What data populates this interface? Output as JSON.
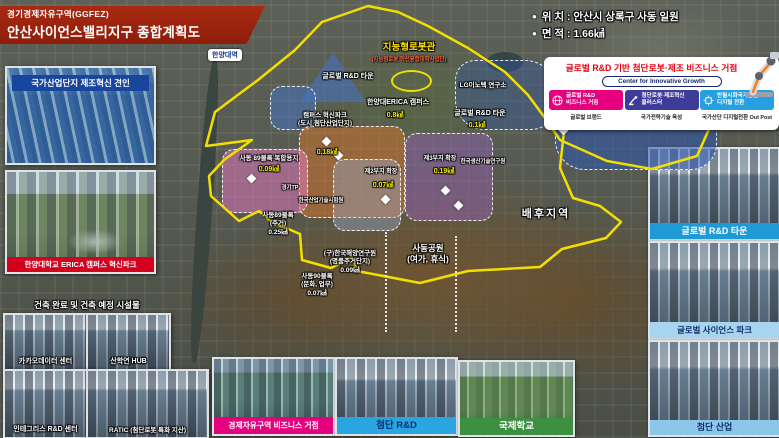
{
  "header": {
    "agency": "경기경제자유구역(GGFEZ)",
    "title": "안산사이언스밸리지구 종합계획도",
    "banner_color": "#8f1d0a"
  },
  "info": {
    "bullet": "●",
    "lines": [
      "위 치 : 안산시 상록구 사동 일원",
      "면 적 : 1.66㎢"
    ]
  },
  "left_column": {
    "industrial_panel": {
      "caption": "국가산업단지 제조혁신 견인",
      "caption_bg": "#18469e"
    },
    "erica_panel": {
      "caption": "한양대학교 ERICA 캠퍼스 혁신파크",
      "caption_bg": "#d3001e"
    },
    "facilities": {
      "heading": "건축 완료 및 건축 예정 시설물",
      "items": [
        {
          "label": "카카오데이터 센터"
        },
        {
          "label": "산학연 HUB"
        },
        {
          "label": "인테그리스 R&D 센터"
        },
        {
          "label": "RATIC (첨단로봇 특화 지산)"
        }
      ]
    }
  },
  "growth_card": {
    "title": "글로벌 R&D 기반 첨단로봇·제조 비즈니스 거점",
    "subtitle": "Center for Innovative Growth",
    "pillars": [
      {
        "line1": "글로벌 R&D",
        "line2": "비즈니스 거점",
        "footer": "글로벌 브랜드",
        "color": "#e6007d",
        "icon": "globe-icon"
      },
      {
        "line1": "첨단로봇·제조혁신",
        "line2": "클러스터",
        "footer": "국가전략기술 육성",
        "color": "#3d3d99",
        "icon": "robot-arm-icon"
      },
      {
        "line1": "반월시화국가산단",
        "line2": "디지털 전환",
        "footer": "국가산단 디지털전환 Out Post",
        "color": "#28a0e0",
        "icon": "digital-icon"
      }
    ]
  },
  "right_column": {
    "panels": [
      {
        "caption": "글로벌 R&D 타운",
        "bg": "#1e9ad6",
        "text": "#ffffff"
      },
      {
        "caption": "글로벌 사이언스 파크",
        "bg": "#a8d4ee",
        "text": "#0c2f6e"
      },
      {
        "caption": "첨단 산업",
        "bg": "#8cc6e8",
        "text": "#0c2f6e"
      }
    ]
  },
  "bottom_row": {
    "panels": [
      {
        "caption": "경제자유구역 비즈니스 거점",
        "bg": "#e6007d",
        "text": "#ffffff"
      },
      {
        "caption": "첨단 R&D",
        "bg": "#29a5e2",
        "text": "#0c2f6e"
      },
      {
        "caption": "국제학교",
        "bg": "#3d8f42",
        "text": "#ffffff"
      }
    ]
  },
  "map": {
    "station": "한양대역",
    "boundary_color": "#f2df00",
    "labels": [
      {
        "name": "label-robot-hall",
        "x": 409,
        "y": 42,
        "cls": "map-title-yellow",
        "lines": [
          "지능형로봇관"
        ]
      },
      {
        "name": "label-robot-hall-sub",
        "x": 409,
        "y": 57,
        "cls": "map-sub-red",
        "lines": [
          "(지능형로봇 혁신융합대학사업단)"
        ]
      },
      {
        "name": "label-global-rnd-west",
        "x": 348,
        "y": 72,
        "cls": "zn",
        "lines": [
          "글로벌 R&D 타운"
        ]
      },
      {
        "name": "label-erica-campus",
        "x": 398,
        "y": 98,
        "cls": "zn",
        "lines": [
          "한양대ERICA 캠퍼스"
        ]
      },
      {
        "name": "label-erica-area",
        "x": 395,
        "y": 111,
        "cls": "av",
        "lines": [
          "0.8㎢"
        ]
      },
      {
        "name": "label-lg-innotek",
        "x": 483,
        "y": 82,
        "cls": "zn sm",
        "lines": [
          "LG이노텍 연구소"
        ]
      },
      {
        "name": "label-global-rnd-east",
        "x": 480,
        "y": 109,
        "cls": "zn",
        "lines": [
          "글로벌 R&D 타운"
        ]
      },
      {
        "name": "label-global-rnd-east-area",
        "x": 477,
        "y": 121,
        "cls": "av",
        "lines": [
          "0.1㎢"
        ]
      },
      {
        "name": "label-campus-innovation-park",
        "x": 325,
        "y": 112,
        "cls": "zn sm",
        "lines": [
          "캠퍼스 혁신파크",
          "(도시 첨단산업단지)"
        ]
      },
      {
        "name": "label-campus-innovation-area",
        "x": 327,
        "y": 148,
        "cls": "av",
        "lines": [
          "0.18㎢"
        ]
      },
      {
        "name": "label-block89-mixed",
        "x": 269,
        "y": 155,
        "cls": "zn sm",
        "lines": [
          "사동 89블록 복합용지"
        ]
      },
      {
        "name": "label-block89-mixed-area",
        "x": 269,
        "y": 165,
        "cls": "av",
        "lines": [
          "0.09㎢"
        ]
      },
      {
        "name": "label-site2-expansion",
        "x": 381,
        "y": 169,
        "cls": "zn xs",
        "lines": [
          "제2부지 확장"
        ]
      },
      {
        "name": "label-site2-area",
        "x": 383,
        "y": 181,
        "cls": "av",
        "lines": [
          "0.07㎢"
        ]
      },
      {
        "name": "label-site3-expansion",
        "x": 440,
        "y": 156,
        "cls": "zn xs",
        "lines": [
          "제3부지 확장"
        ]
      },
      {
        "name": "label-site3-area",
        "x": 444,
        "y": 167,
        "cls": "av",
        "lines": [
          "0.19㎢"
        ]
      },
      {
        "name": "label-kitech",
        "x": 483,
        "y": 159,
        "cls": "zn xxs",
        "lines": [
          "한국생산기술연구원"
        ]
      },
      {
        "name": "label-gyeonggi-tp",
        "x": 290,
        "y": 185,
        "cls": "zn xxs",
        "lines": [
          "경기TP"
        ]
      },
      {
        "name": "label-ktl",
        "x": 321,
        "y": 198,
        "cls": "zn xxs",
        "lines": [
          "한국산업기술시험원"
        ]
      },
      {
        "name": "label-block89-housing",
        "x": 278,
        "y": 212,
        "cls": "zn sm",
        "lines": [
          "사동89블록",
          "(주거)",
          "0.25㎢"
        ]
      },
      {
        "name": "label-ex-kordi",
        "x": 350,
        "y": 250,
        "cls": "zn sm",
        "lines": [
          "(구)한국해양연구원",
          "(명품주거단지)",
          "0.09㎢"
        ]
      },
      {
        "name": "label-block90",
        "x": 317,
        "y": 273,
        "cls": "zn sm",
        "lines": [
          "사동90블록",
          "(문화, 업무)",
          "0.07㎢"
        ]
      },
      {
        "name": "label-sadong-park",
        "x": 428,
        "y": 243,
        "cls": "zn md",
        "lines": [
          "사동공원",
          "(여가, 휴식)"
        ]
      },
      {
        "name": "label-hinterland",
        "x": 546,
        "y": 207,
        "cls": "zn lg",
        "lines": [
          "배후지역"
        ]
      }
    ],
    "zones": [
      {
        "name": "zone-global-rnd-west-tri",
        "x": 300,
        "y": 52,
        "w": 66,
        "h": 50,
        "shape": "tri",
        "color": "rgba(70,115,200,0.55)"
      },
      {
        "name": "zone-global-rnd-west-rect",
        "x": 270,
        "y": 86,
        "w": 44,
        "h": 42,
        "shape": "blob",
        "color": "rgba(70,115,200,0.5)"
      },
      {
        "name": "zone-campus-innovation-park",
        "x": 299,
        "y": 126,
        "w": 104,
        "h": 90,
        "shape": "blob",
        "color": "rgba(205,115,45,0.55)"
      },
      {
        "name": "zone-block89-mixed",
        "x": 222,
        "y": 149,
        "w": 84,
        "h": 62,
        "shape": "blob",
        "color": "rgba(232,120,195,0.5)"
      },
      {
        "name": "zone-site2-expansion",
        "x": 333,
        "y": 159,
        "w": 66,
        "h": 70,
        "shape": "blob",
        "color": "rgba(150,170,205,0.4)"
      },
      {
        "name": "zone-site3-expansion",
        "x": 405,
        "y": 133,
        "w": 86,
        "h": 86,
        "shape": "blob",
        "color": "rgba(145,95,175,0.5)"
      },
      {
        "name": "zone-global-rnd-east",
        "x": 555,
        "y": 95,
        "w": 160,
        "h": 73,
        "shape": "lobe",
        "color": "rgba(45,85,175,0.55)"
      },
      {
        "name": "zone-global-rnd-pond",
        "x": 455,
        "y": 60,
        "w": 100,
        "h": 68,
        "shape": "lobe",
        "color": "rgba(45,85,175,0.35)"
      }
    ],
    "markers": [
      [
        323,
        138
      ],
      [
        248,
        175
      ],
      [
        382,
        196
      ],
      [
        442,
        187
      ],
      [
        455,
        202
      ],
      [
        560,
        127
      ],
      [
        612,
        119
      ],
      [
        335,
        152
      ]
    ]
  }
}
